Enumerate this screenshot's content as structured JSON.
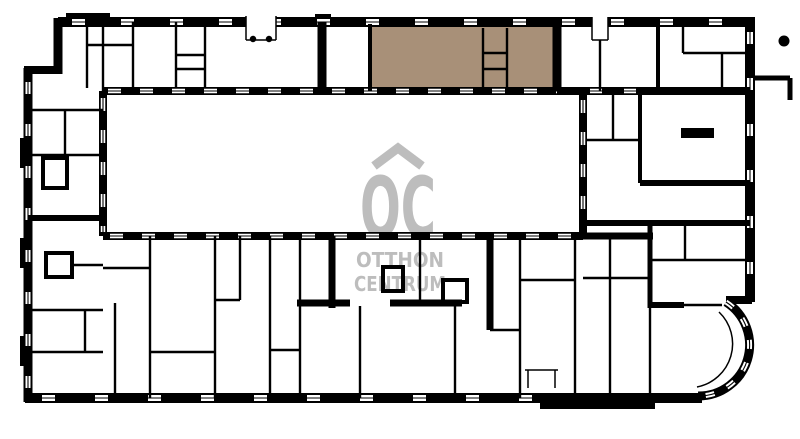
{
  "colors": {
    "background": "#ffffff",
    "wall": "#000000",
    "highlight": "#a89078",
    "watermark": "#bdbdbd"
  },
  "watermark": {
    "monogram": "OC",
    "line1": "OTTHON",
    "line2": "CENTRUM"
  },
  "plan": {
    "type": "apartment-building-floor-plan",
    "highlighted_unit": "top-center apartment filled in brown"
  }
}
